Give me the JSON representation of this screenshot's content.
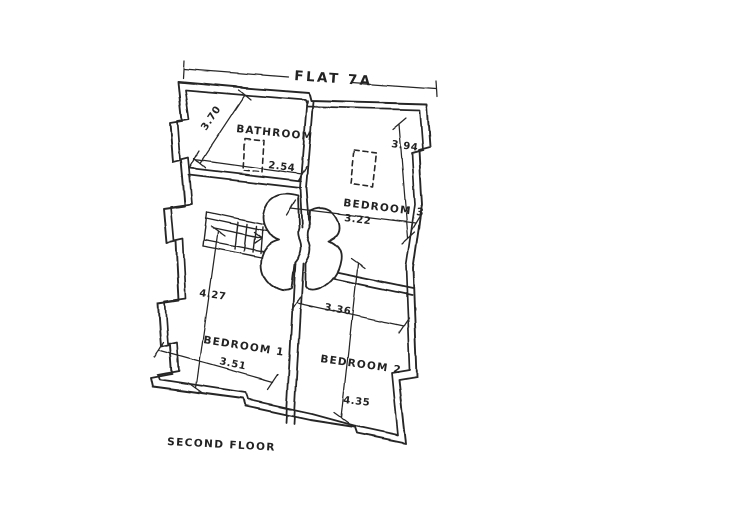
{
  "plan": {
    "title": "FLAT 7A",
    "floor_label": "SECOND FLOOR",
    "ink_color": "#262626",
    "paper_color": "#ffffff",
    "rooms": [
      {
        "id": "bathroom",
        "label": "BATHROOM",
        "width_m": "2.54",
        "length_m": "3.70"
      },
      {
        "id": "bedroom-3",
        "label": "BEDROOM 3",
        "width_m": "3.22",
        "length_m": "3.94"
      },
      {
        "id": "bedroom-1",
        "label": "BEDROOM 1",
        "width_m": "3.51",
        "length_m": "4.27"
      },
      {
        "id": "bedroom-2",
        "label": "BEDROOM 2",
        "width_m": "3.36",
        "length_m": "4.35"
      }
    ]
  }
}
